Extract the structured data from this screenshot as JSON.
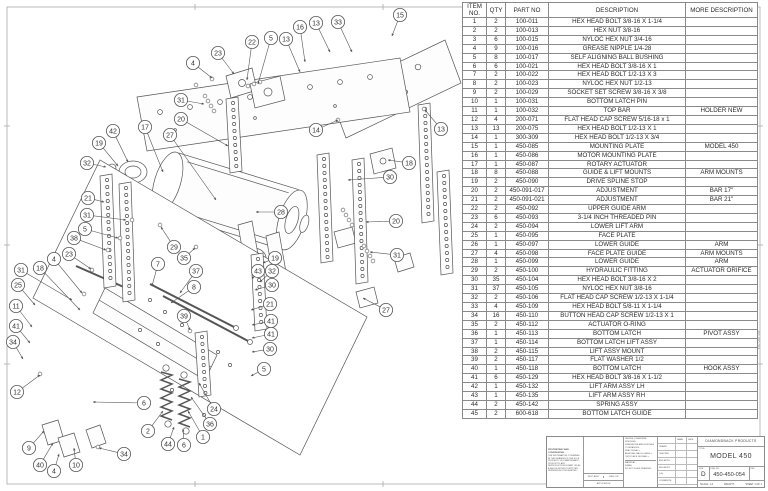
{
  "sheet": {
    "margin_note": "450-450-054"
  },
  "parts_table": {
    "columns": [
      "ITEM NO.",
      "QTY",
      "PART NO",
      "DESCRIPTION",
      "MORE DESCRIPTION"
    ],
    "rows": [
      [
        "1",
        "2",
        "100-011",
        "HEX HEAD BOLT 3/8-16 X 1-1/4",
        ""
      ],
      [
        "2",
        "2",
        "100-013",
        "HEX NUT 3/8-16",
        ""
      ],
      [
        "3",
        "6",
        "100-015",
        "NYLOC HEX NUT 3/4-16",
        ""
      ],
      [
        "4",
        "9",
        "100-016",
        "GREASE NIPPLE 1/4-28",
        ""
      ],
      [
        "5",
        "8",
        "100-017",
        "SELF ALIGNING BALL BUSHING",
        ""
      ],
      [
        "6",
        "6",
        "100-021",
        "HEX HEAD BOLT 3/8-16 X 1",
        ""
      ],
      [
        "7",
        "2",
        "100-022",
        "HEX HEAD BOLT 1/2-13 X 3",
        ""
      ],
      [
        "8",
        "2",
        "100-023",
        "NYLOC HEX NUT 1/2-13",
        ""
      ],
      [
        "9",
        "2",
        "100-029",
        "SOCKET SET SCREW 3/8-16 X 3/8",
        ""
      ],
      [
        "10",
        "1",
        "100-031",
        "BOTTOM LATCH PIN",
        ""
      ],
      [
        "11",
        "1",
        "100-032",
        "TOP BAR",
        "HOLDER NEW"
      ],
      [
        "12",
        "4",
        "200-071",
        "FLAT HEAD CAP SCREW 5/16-18 x 1",
        ""
      ],
      [
        "13",
        "13",
        "200-075",
        "HEX HEAD BOLT 1/2-13 X 1",
        ""
      ],
      [
        "14",
        "1",
        "300-309",
        "HEX HEAD BOLT 1/2-13 X 3/4",
        ""
      ],
      [
        "15",
        "1",
        "450-085",
        "MOUNTING PLATE",
        "MODEL 450"
      ],
      [
        "16",
        "1",
        "450-086",
        "MOTOR MOUNTING PLATE",
        ""
      ],
      [
        "17",
        "1",
        "450-087",
        "ROTARY ACTUATOR",
        ""
      ],
      [
        "18",
        "8",
        "450-088",
        "GUIDE & LIFT MOUNTS",
        "ARM MOUNTS"
      ],
      [
        "19",
        "2",
        "450-090",
        "DRIVE SPLINE STOP",
        ""
      ],
      [
        "20",
        "2",
        "450-091-017",
        "ADJUSTMENT",
        "BAR 17\""
      ],
      [
        "21",
        "2",
        "450-091-021",
        "ADJUSTMENT",
        "BAR 21\""
      ],
      [
        "22",
        "2",
        "450-092",
        "UPPER GUIDE ARM",
        ""
      ],
      [
        "23",
        "6",
        "450-093",
        "3-1/4 INCH THREADED PIN",
        ""
      ],
      [
        "24",
        "2",
        "450-094",
        "LOWER LIFT ARM",
        ""
      ],
      [
        "25",
        "1",
        "450-095",
        "FACE PLATE",
        ""
      ],
      [
        "26",
        "1",
        "450-097",
        "LOWER GUIDE",
        "ARM"
      ],
      [
        "27",
        "4",
        "450-098",
        "FACE PLATE GUIDE",
        "ARM MOUNTS"
      ],
      [
        "28",
        "1",
        "450-099",
        "LOWER GUIDE",
        "ARM"
      ],
      [
        "29",
        "2",
        "450-100",
        "HYDRAULIC FITTING",
        "ACTUATOR ORIFICE"
      ],
      [
        "30",
        "35",
        "450-104",
        "HEX HEAD BOLT 3/8-16 X 2",
        ""
      ],
      [
        "31",
        "37",
        "450-105",
        "NYLOC HEX NUT 3/8-16",
        ""
      ],
      [
        "32",
        "2",
        "450-106",
        "FLAT HEAD CAP SCREW 1/2-13 X 1-1/4",
        ""
      ],
      [
        "33",
        "4",
        "450-109",
        "HEX HEAD BOLT 5/8-11 X 1-1/4",
        ""
      ],
      [
        "34",
        "16",
        "450-110",
        "BUTTON HEAD CAP SCREW 1/2-13 X 1",
        ""
      ],
      [
        "35",
        "2",
        "450-112",
        "ACTUATOR O-RING",
        ""
      ],
      [
        "36",
        "1",
        "450-113",
        "BOTTOM LATCH",
        "PIVOT ASSY"
      ],
      [
        "37",
        "1",
        "450-114",
        "BOTTOM LATCH LIFT ASSY",
        ""
      ],
      [
        "38",
        "2",
        "450-115",
        "LIFT ASSY MOUNT",
        ""
      ],
      [
        "39",
        "2",
        "450-117",
        "FLAT WASHER 1/2",
        ""
      ],
      [
        "40",
        "1",
        "450-118",
        "BOTTOM LATCH",
        "HOOK ASSY"
      ],
      [
        "41",
        "6",
        "450-129",
        "HEX HEAD BOLT 3/8-16 X 1-1/2",
        ""
      ],
      [
        "42",
        "1",
        "450-132",
        "LIFT ARM ASSY LH",
        ""
      ],
      [
        "43",
        "1",
        "450-135",
        "LIFT ARM ASSY RH",
        ""
      ],
      [
        "44",
        "2",
        "450-142",
        "SPRING ASSY",
        ""
      ],
      [
        "45",
        "2",
        "600-618",
        "BOTTOM LATCH GUIDE",
        ""
      ]
    ]
  },
  "title_block": {
    "company": "DIAMONDBACK PRODUCTS",
    "title_label": "TITLE:",
    "title": "MODEL 450",
    "size_label": "SIZE",
    "size": "D",
    "dwg_label": "DWG. NO.",
    "dwg_no": "450-450-054",
    "rev_label": "REV",
    "scale_text": "SCALE: 1:4",
    "weight_text": "WEIGHT:",
    "sheet_text": "SHEET 1 OF 1",
    "tolerance_header": "UNLESS OTHERWISE SPECIFIED:",
    "tolerance_lines": [
      "DIMENSIONS ARE IN INCHES",
      "TOLERANCES:",
      "FRACTIONAL ±",
      "ANGULAR: MACH ±  BEND ±",
      "TWO PLACE DECIMAL  ±"
    ],
    "material_label": "MATERIAL",
    "finish_label": "FINISH",
    "do_not_scale": "DO NOT SCALE DRAWING",
    "name_label": "NAME",
    "date_label": "DATE",
    "sign_rows": [
      "DRAWN",
      "CHECKED",
      "ENG APPR.",
      "MFG APPR.",
      "Q.A.",
      "COMMENTS:"
    ],
    "proprietary": "PROPRIETARY AND CONFIDENTIAL",
    "proprietary_body": "THE INFORMATION CONTAINED IN THIS DRAWING IS THE SOLE PROPERTY OF DIAMONDBACK PRODUCTS. ANY REPRODUCTION IN PART OR AS A WHOLE WITHOUT WRITTEN PERMISSION IS PROHIBITED.",
    "next_assy": "NEXT ASSY",
    "used_on": "USED ON",
    "application": "APPLICATION"
  },
  "diagram": {
    "balloons": [
      {
        "n": "15",
        "x": 400,
        "y": 15,
        "tx": 392,
        "ty": 36
      },
      {
        "n": "33",
        "x": 338,
        "y": 22,
        "tx": 352,
        "ty": 52
      },
      {
        "n": "13",
        "x": 316,
        "y": 23,
        "tx": 330,
        "ty": 52
      },
      {
        "n": "16",
        "x": 300,
        "y": 27,
        "tx": 305,
        "ty": 62
      },
      {
        "n": "13",
        "x": 286,
        "y": 39,
        "tx": 300,
        "ty": 72
      },
      {
        "n": "5",
        "x": 271,
        "y": 38,
        "tx": 258,
        "ty": 84
      },
      {
        "n": "22",
        "x": 252,
        "y": 42,
        "tx": 247,
        "ty": 80
      },
      {
        "n": "23",
        "x": 218,
        "y": 53,
        "tx": 234,
        "ty": 74
      },
      {
        "n": "4",
        "x": 193,
        "y": 63,
        "tx": 212,
        "ty": 78
      },
      {
        "n": "31",
        "x": 181,
        "y": 100,
        "tx": 204,
        "ty": 104
      },
      {
        "n": "20",
        "x": 181,
        "y": 119,
        "tx": 228,
        "ty": 146
      },
      {
        "n": "42",
        "x": 113,
        "y": 131,
        "tx": 128,
        "ty": 162
      },
      {
        "n": "17",
        "x": 145,
        "y": 127,
        "tx": 163,
        "ty": 172
      },
      {
        "n": "27",
        "x": 170,
        "y": 135,
        "tx": 216,
        "ty": 200
      },
      {
        "n": "19",
        "x": 99,
        "y": 143,
        "tx": 118,
        "ty": 166
      },
      {
        "n": "32",
        "x": 87,
        "y": 163,
        "tx": 106,
        "ty": 167
      },
      {
        "n": "21",
        "x": 88,
        "y": 198,
        "tx": 104,
        "ty": 202
      },
      {
        "n": "31",
        "x": 87,
        "y": 215,
        "tx": 126,
        "ty": 220
      },
      {
        "n": "5",
        "x": 85,
        "y": 229,
        "tx": 118,
        "ty": 238
      },
      {
        "n": "38",
        "x": 74,
        "y": 238,
        "tx": 106,
        "ty": 250
      },
      {
        "n": "14",
        "x": 316,
        "y": 130,
        "tx": 338,
        "ty": 120
      },
      {
        "n": "13",
        "x": 441,
        "y": 129,
        "tx": 425,
        "ty": 110
      },
      {
        "n": "18",
        "x": 409,
        "y": 163,
        "tx": 388,
        "ty": 160
      },
      {
        "n": "30",
        "x": 390,
        "y": 177,
        "tx": 348,
        "ty": 180
      },
      {
        "n": "20",
        "x": 396,
        "y": 221,
        "tx": 366,
        "ty": 222
      },
      {
        "n": "28",
        "x": 281,
        "y": 212,
        "tx": 256,
        "ty": 212
      },
      {
        "n": "29",
        "x": 174,
        "y": 247,
        "tx": 161,
        "ty": 227
      },
      {
        "n": "35",
        "x": 184,
        "y": 258,
        "tx": 195,
        "ty": 248
      },
      {
        "n": "7",
        "x": 158,
        "y": 264,
        "tx": 152,
        "ty": 286
      },
      {
        "n": "37",
        "x": 196,
        "y": 271,
        "tx": 180,
        "ty": 293
      },
      {
        "n": "8",
        "x": 194,
        "y": 287,
        "tx": 171,
        "ty": 303
      },
      {
        "n": "39",
        "x": 184,
        "y": 316,
        "tx": 190,
        "ty": 330
      },
      {
        "n": "23",
        "x": 69,
        "y": 254,
        "tx": 91,
        "ty": 269
      },
      {
        "n": "4",
        "x": 54,
        "y": 259,
        "tx": 82,
        "ty": 293
      },
      {
        "n": "31",
        "x": 21,
        "y": 270,
        "tx": 72,
        "ty": 300
      },
      {
        "n": "18",
        "x": 40,
        "y": 268,
        "tx": 80,
        "ty": 310
      },
      {
        "n": "25",
        "x": 18,
        "y": 285,
        "tx": 35,
        "ty": 305
      },
      {
        "n": "11",
        "x": 16,
        "y": 306,
        "tx": 32,
        "ty": 327
      },
      {
        "n": "41",
        "x": 16,
        "y": 326,
        "tx": 30,
        "ty": 343
      },
      {
        "n": "34",
        "x": 13,
        "y": 342,
        "tx": 23,
        "ty": 359
      },
      {
        "n": "12",
        "x": 17,
        "y": 392,
        "tx": 40,
        "ty": 375
      },
      {
        "n": "9",
        "x": 29,
        "y": 448,
        "tx": 44,
        "ty": 431
      },
      {
        "n": "40",
        "x": 40,
        "y": 465,
        "tx": 53,
        "ty": 443
      },
      {
        "n": "4",
        "x": 54,
        "y": 471,
        "tx": 59,
        "ty": 454
      },
      {
        "n": "10",
        "x": 76,
        "y": 465,
        "tx": 74,
        "ty": 448
      },
      {
        "n": "34",
        "x": 124,
        "y": 454,
        "tx": 99,
        "ty": 448
      },
      {
        "n": "6",
        "x": 144,
        "y": 403,
        "tx": 93,
        "ty": 402
      },
      {
        "n": "2",
        "x": 148,
        "y": 431,
        "tx": 163,
        "ty": 411
      },
      {
        "n": "44",
        "x": 168,
        "y": 444,
        "tx": 174,
        "ty": 427
      },
      {
        "n": "6",
        "x": 184,
        "y": 445,
        "tx": 183,
        "ty": 429
      },
      {
        "n": "1",
        "x": 203,
        "y": 437,
        "tx": 188,
        "ty": 411
      },
      {
        "n": "36",
        "x": 210,
        "y": 424,
        "tx": 191,
        "ty": 397
      },
      {
        "n": "24",
        "x": 214,
        "y": 409,
        "tx": 199,
        "ty": 383
      },
      {
        "n": "19",
        "x": 275,
        "y": 258,
        "tx": 263,
        "ty": 263
      },
      {
        "n": "43",
        "x": 258,
        "y": 271,
        "tx": 252,
        "ty": 279
      },
      {
        "n": "32",
        "x": 272,
        "y": 271,
        "tx": 260,
        "ty": 282
      },
      {
        "n": "30",
        "x": 272,
        "y": 285,
        "tx": 255,
        "ty": 290
      },
      {
        "n": "21",
        "x": 270,
        "y": 304,
        "tx": 251,
        "ty": 310
      },
      {
        "n": "41",
        "x": 271,
        "y": 321,
        "tx": 252,
        "ty": 325
      },
      {
        "n": "41",
        "x": 271,
        "y": 334,
        "tx": 252,
        "ty": 338
      },
      {
        "n": "30",
        "x": 270,
        "y": 349,
        "tx": 252,
        "ty": 352
      },
      {
        "n": "5",
        "x": 264,
        "y": 369,
        "tx": 251,
        "ty": 376
      },
      {
        "n": "31",
        "x": 397,
        "y": 255,
        "tx": 370,
        "ty": 252
      },
      {
        "n": "27",
        "x": 386,
        "y": 310,
        "tx": 363,
        "ty": 298
      }
    ]
  }
}
